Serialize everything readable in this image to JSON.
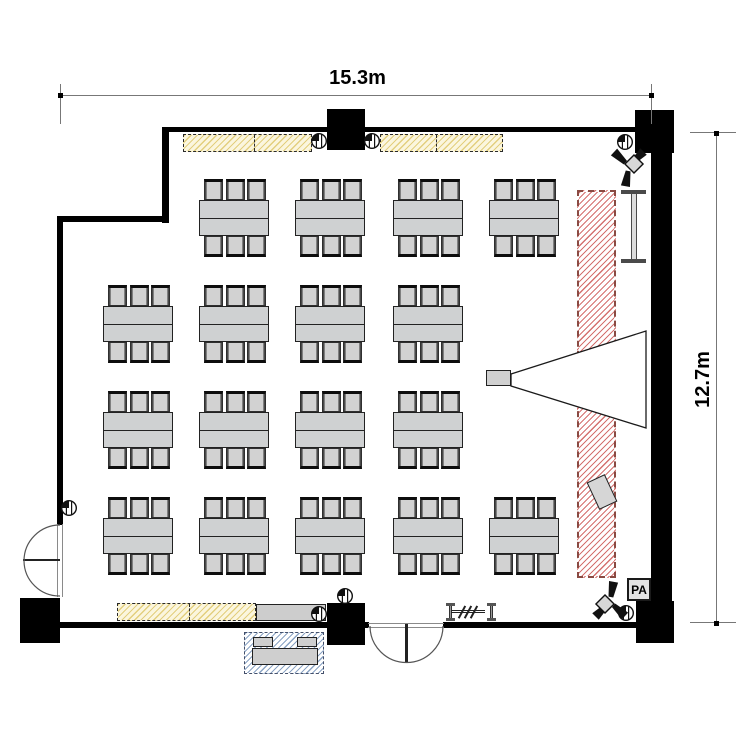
{
  "plan": {
    "pa_label": "PA",
    "dimensions": {
      "width_label": "15.3m",
      "height_label": "12.7m",
      "top": {
        "x1": 61,
        "x2": 652,
        "y": 95,
        "tick_y1": 84,
        "tick_y2": 124
      },
      "right": {
        "y1": 133,
        "y2": 623,
        "x": 716,
        "tick_x1": 690,
        "tick_x2": 736
      }
    },
    "colors": {
      "wall": "#000000",
      "furniture_fill": "#d0d0d0",
      "furniture_border": "#222222",
      "cabinet_fill": "#fbf6de",
      "cabinet_hatch": "#e3cf7e",
      "screen_hatch": "#d4716f",
      "screen_border": "#8a4a42",
      "service_hatch": "#8aa3c4",
      "dimension_line": "#777777"
    },
    "walls": [
      {
        "x": 162,
        "y": 127,
        "w": 492,
        "h": 5
      },
      {
        "x": 162,
        "y": 127,
        "w": 7,
        "h": 96
      },
      {
        "x": 57,
        "y": 216,
        "w": 112,
        "h": 6
      },
      {
        "x": 57,
        "y": 216,
        "w": 6,
        "h": 309
      },
      {
        "x": 58,
        "y": 622,
        "w": 311,
        "h": 6
      },
      {
        "x": 443,
        "y": 622,
        "w": 196,
        "h": 6
      },
      {
        "x": 651,
        "y": 131,
        "w": 21,
        "h": 512
      }
    ],
    "pillars": [
      {
        "x": 327,
        "y": 109,
        "w": 38,
        "h": 41
      },
      {
        "x": 635,
        "y": 110,
        "w": 39,
        "h": 43
      },
      {
        "x": 636,
        "y": 601,
        "w": 38,
        "h": 42
      },
      {
        "x": 327,
        "y": 603,
        "w": 38,
        "h": 42
      },
      {
        "x": 20,
        "y": 598,
        "w": 40,
        "h": 45
      }
    ],
    "tables": {
      "size": {
        "w": 70,
        "h": 36
      },
      "chairs_per_side": 3,
      "chair": {
        "w": 19,
        "h": 21
      },
      "chair_offsets": [
        5,
        26.5,
        48
      ],
      "groups": [
        {
          "x": 199,
          "y": 200
        },
        {
          "x": 295,
          "y": 200
        },
        {
          "x": 393,
          "y": 200
        },
        {
          "x": 489,
          "y": 200
        },
        {
          "x": 103,
          "y": 306
        },
        {
          "x": 199,
          "y": 306
        },
        {
          "x": 295,
          "y": 306
        },
        {
          "x": 393,
          "y": 306
        },
        {
          "x": 103,
          "y": 412
        },
        {
          "x": 199,
          "y": 412
        },
        {
          "x": 295,
          "y": 412
        },
        {
          "x": 393,
          "y": 412
        },
        {
          "x": 103,
          "y": 518
        },
        {
          "x": 199,
          "y": 518
        },
        {
          "x": 295,
          "y": 518
        },
        {
          "x": 393,
          "y": 518
        },
        {
          "x": 489,
          "y": 518
        }
      ]
    },
    "cabinets": [
      {
        "x": 183,
        "y": 134,
        "w": 129,
        "h": 18,
        "divider": 70
      },
      {
        "x": 380,
        "y": 134,
        "w": 123,
        "h": 18,
        "divider": 55
      },
      {
        "x": 117,
        "y": 603,
        "w": 139,
        "h": 18,
        "divider": 71
      }
    ],
    "counter": {
      "x": 256,
      "y": 604,
      "w": 70,
      "h": 17
    },
    "service_table": {
      "x": 244,
      "y": 632,
      "w": 80,
      "h": 42,
      "top": {
        "dx": 8,
        "dy": 16,
        "w": 66,
        "h": 17
      },
      "items": [
        {
          "dx": 9,
          "dy": 5,
          "w": 20,
          "h": 10
        },
        {
          "dx": 53,
          "dy": 5,
          "w": 20,
          "h": 10
        }
      ]
    },
    "screen": {
      "x": 577,
      "y": 190,
      "w": 39,
      "h": 388
    },
    "whiteboard": {
      "x": 621,
      "y": 190,
      "w": 25,
      "h": 73,
      "bar_h": 4,
      "stem_w": 6
    },
    "projector": {
      "x": 486,
      "y": 370,
      "w": 25,
      "h": 16,
      "cone_points": "511,374 646,331 646,428 511,386"
    },
    "lectern": {
      "x": 592,
      "y": 477,
      "w": 20,
      "h": 30
    },
    "pa_box": {
      "x": 627,
      "y": 578,
      "w": 24,
      "h": 23
    },
    "speakers": [
      {
        "cx": 629,
        "cy": 166,
        "rotate": 0
      },
      {
        "cx": 610,
        "cy": 602,
        "rotate": 180
      }
    ],
    "wall_outlets": [
      {
        "cx": 319,
        "cy": 141
      },
      {
        "cx": 372,
        "cy": 141
      },
      {
        "cx": 625,
        "cy": 142
      },
      {
        "cx": 69,
        "cy": 508
      },
      {
        "cx": 345,
        "cy": 596
      },
      {
        "cx": 319,
        "cy": 614
      },
      {
        "cx": 626,
        "cy": 613
      }
    ],
    "doors": [
      {
        "name": "left-exit-door",
        "frame": [
          {
            "x": 57,
            "y": 524,
            "w": 1,
            "h": 73
          },
          {
            "x": 61.5,
            "y": 524,
            "w": 1,
            "h": 73
          }
        ],
        "tip": {
          "x": 23,
          "y": 559.3,
          "w": 37,
          "h": 2.2
        },
        "arcs": [
          "M60,525 A36,36 0 0 0 24,561",
          "M60,596 A35.5,35.5 0 0 1 24,561"
        ]
      },
      {
        "name": "main-entrance-door",
        "frame": [
          {
            "x": 368,
            "y": 622.5,
            "w": 76,
            "h": 1
          },
          {
            "x": 368,
            "y": 626.5,
            "w": 76,
            "h": 1
          }
        ],
        "tip": {
          "x": 405.4,
          "y": 624,
          "w": 2.2,
          "h": 38
        },
        "arcs": [
          "M370,626 A36.5,36.5 0 0 0 406.5,662.5",
          "M443,626 A36.5,36.5 0 0 1 406.5,662.5"
        ]
      }
    ],
    "partition": {
      "x": 446,
      "y": 603,
      "w": 44,
      "h": 18
    }
  }
}
